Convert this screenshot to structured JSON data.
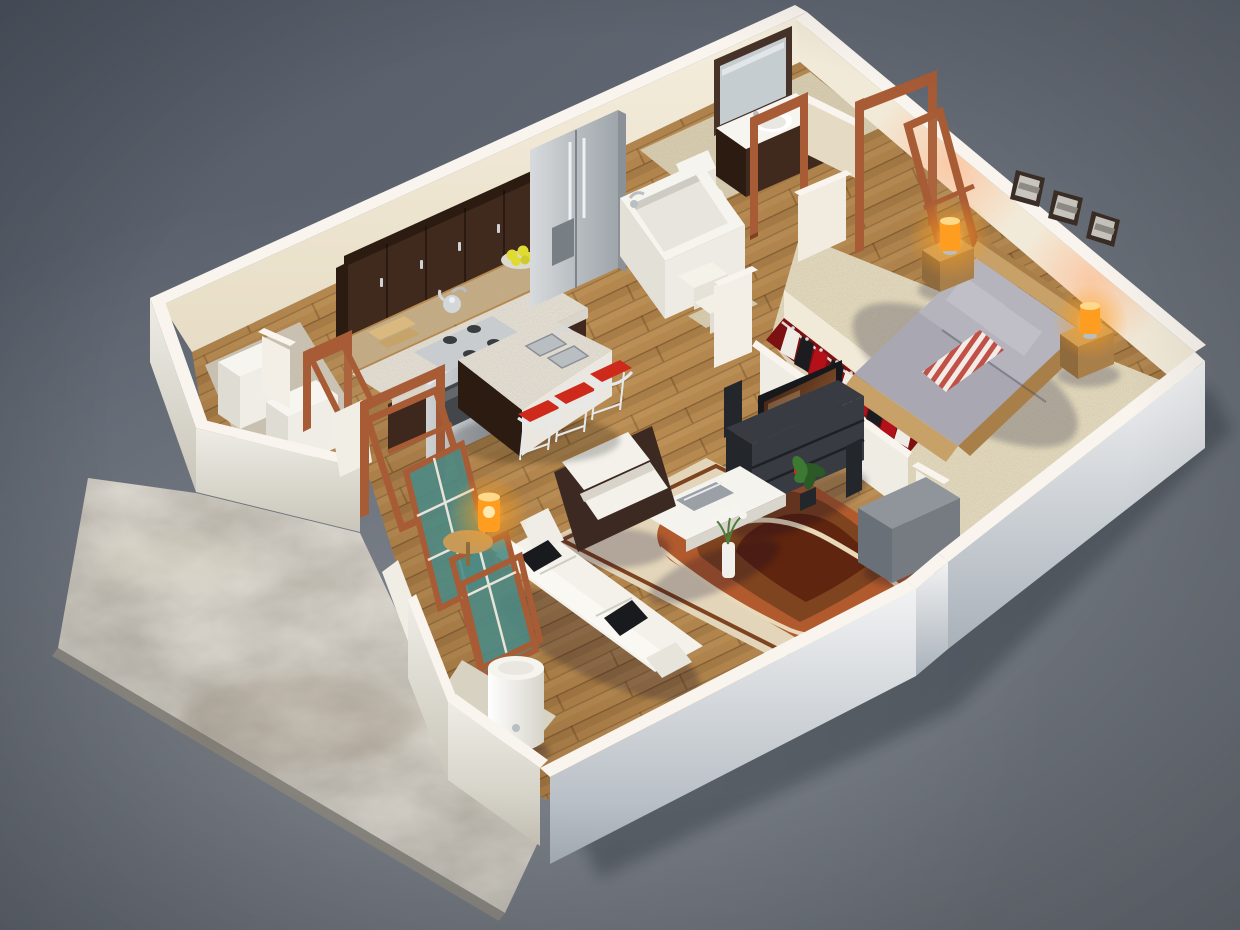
{
  "scene": {
    "type": "3d-floor-plan-render",
    "description": "Photorealistic isometric 3D render of a one-bedroom apartment floor plan viewed from above: open kitchen with espresso cabinets and granite island with red bar stools, bathroom with tub, toilet and vanity, bedroom with double bed, orange table lamps and three wall pictures, walk-in closet with hanging clothes, living room with white sofa, armchair, TV console and patterned rug, laundry nook with washer and dryer, entry with wooden door frames and glazed panels, white cylindrical water heater, and an exterior concrete patio on a slate gray backdrop.",
    "rooms": [
      "kitchen",
      "bathroom",
      "bedroom",
      "closet",
      "living-room",
      "laundry-storage",
      "entry",
      "patio"
    ]
  },
  "objects": {
    "kitchen": [
      "espresso-upper-cabinets",
      "mosaic-backsplash",
      "granite-countertop",
      "stainless-gas-range",
      "kettle",
      "cutting-boards",
      "bowl-of-lemons",
      "stainless-fridge",
      "granite-island",
      "double-sink",
      "bar-stool (x3)"
    ],
    "bathroom": [
      "bathtub",
      "tub-steps",
      "toilet",
      "wood-vanity-with-sink",
      "framed-mirror",
      "open-door-frame"
    ],
    "bedroom": [
      "platform-double-bed",
      "gray-bedding",
      "striped-throw-blanket",
      "nightstand (x2)",
      "orange-table-lamp (x2)",
      "framed-wall-picture (x3)",
      "open-door-with-swung-leaf"
    ],
    "closet": [
      "clothes-rail",
      "hanging-garments"
    ],
    "living_room": [
      "white-sofa",
      "black-accent-pillows",
      "white-armchair",
      "white-coffee-table",
      "flower-vase",
      "gray-ottoman",
      "patterned-area-rug",
      "flat-screen-tv",
      "dark-media-console",
      "speaker-towers",
      "house-plant"
    ],
    "laundry_storage": [
      "washer",
      "dryer",
      "open-door-frame"
    ],
    "entry": [
      "open-entry-door-frame",
      "teal-glazed-window-panels",
      "leaning-door-frame",
      "orange-accent-lamp",
      "round-side-table",
      "water-heater-cylinder"
    ],
    "exterior": [
      "concrete-patio-slab",
      "soft-building-shadow"
    ]
  },
  "counts": {
    "bar_stools": 3,
    "wall_pictures": 3,
    "bedroom_lamps": 2,
    "nightstands": 2,
    "sofa_pillows": 3,
    "window_panels": 2,
    "appliance_boxes": 2
  },
  "palette": {
    "bg_top": "#565d69",
    "bg_mid": "#666c76",
    "bg_bottom": "#71767d",
    "concrete": "#b3aea4",
    "concrete_shadow": "#8e8b84",
    "wall_top": "#f9f5ee",
    "wall_inner": "#f2ead8",
    "wall_inner_shade": "#e5dbc5",
    "wall_outer_light": "#eff1f2",
    "wall_outer_deep": "#aeb6bd",
    "wall_west": "#e9e6de",
    "floor_wood": "#b78a50",
    "wood_line": "#7d5426",
    "carpet": "#e8dfc2",
    "tile": "#dcd2b4",
    "cabinet": "#40291d",
    "cabinet_side": "#2c1b11",
    "granite": "#eae6dc",
    "backsplash": "#c7ae82",
    "steel_dark": "#777e84",
    "stool_red": "#cd2a1c",
    "chrome": "#e6e9eb",
    "lemon": "#dfdb33",
    "door_wood": "#a85c36",
    "door_wood_dark": "#7c4023",
    "glass_teal": "#4d8a84",
    "sofa": "#f3f1ea",
    "sofa_shade": "#d8d4c9",
    "pillow_black": "#191a1e",
    "rug_cream": "#e3d5ba",
    "rug_rust": "#b05a2e",
    "rug_brown": "#7e431f",
    "rug_dark": "#5f250f",
    "tv_black": "#17181c",
    "console": "#383c42",
    "console_dark": "#23262b",
    "plant": "#3c7a33",
    "plant_dark": "#2c5a26",
    "bed_gray": "#a9a8b2",
    "bed_gray_light": "#c0bfc8",
    "bed_wood": "#c7a167",
    "bed_wood_dark": "#a97f49",
    "throw_red": "#c05048",
    "lamp_orange": "#ff9d20",
    "closet_red": "#7d1010",
    "heater": "#f6f4ee",
    "mirror_glass": "#c6cdd1",
    "ottoman": "#8f959b",
    "ottoman_dark": "#757b81",
    "ottoman_side": "#697077",
    "shadow": "#10141b"
  }
}
